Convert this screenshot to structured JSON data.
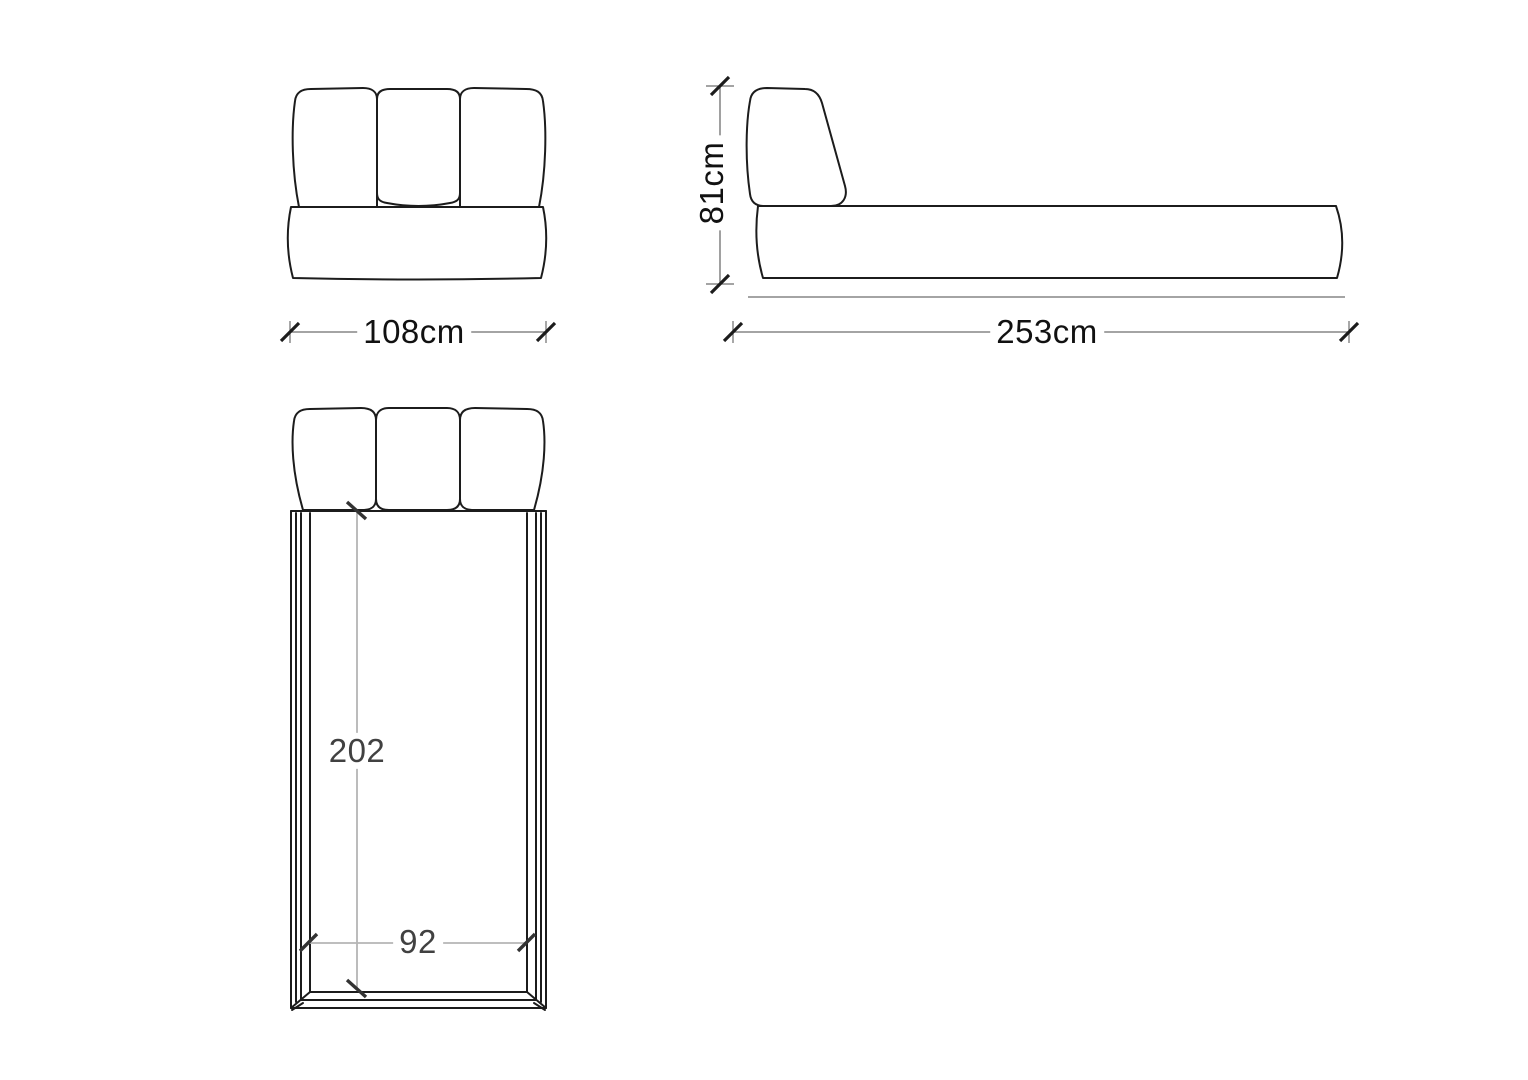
{
  "drawing": {
    "front_view": {
      "width_dimension": "108cm"
    },
    "side_view": {
      "height_dimension": "81cm",
      "length_dimension": "253cm"
    },
    "top_view": {
      "length_dimension": "202",
      "width_dimension": "92"
    }
  },
  "colors": {
    "background": "#ffffff",
    "line_color": "#1c1c1c",
    "dim_line_color": "#6e6e6e",
    "dim_light_color": "#b5b5b5",
    "label_color": "#111111",
    "plan_label_color": "#414141"
  }
}
